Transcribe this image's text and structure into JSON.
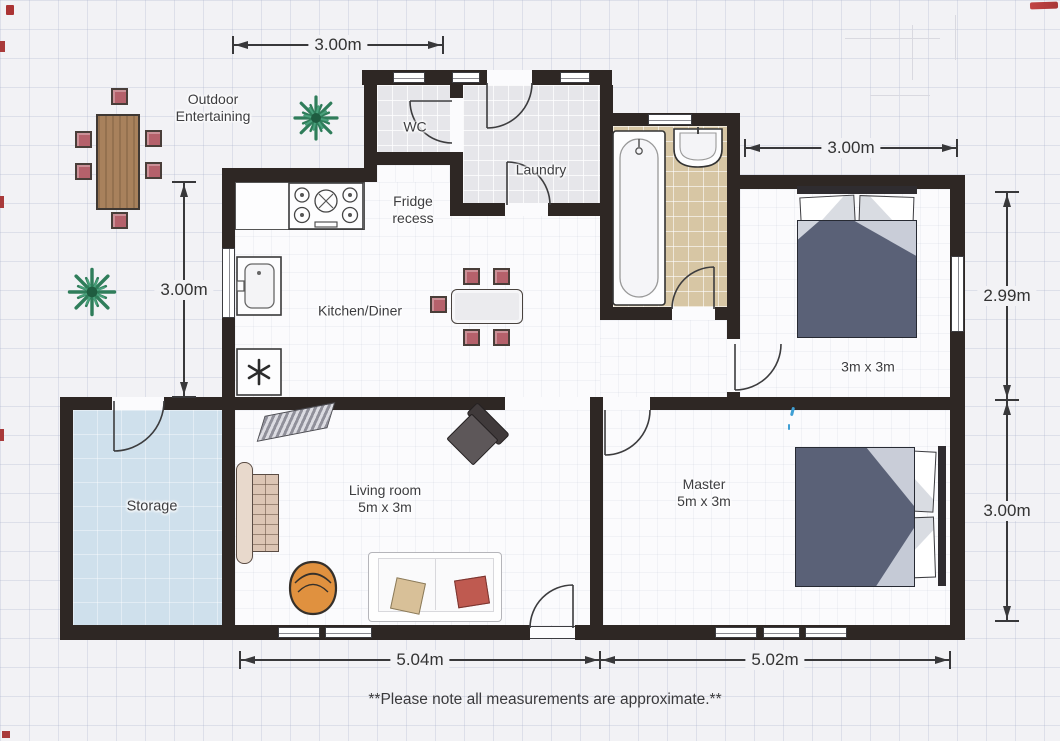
{
  "plan": {
    "note": "**Please note all measurements are approximate.**",
    "rooms": {
      "outdoor": {
        "line1": "Outdoor",
        "line2": "Entertaining"
      },
      "wc": {
        "name": "WC"
      },
      "laundry": {
        "name": "Laundry"
      },
      "fridge_recess": {
        "line1": "Fridge",
        "line2": "recess"
      },
      "kitchen": {
        "name": "Kitchen/Diner"
      },
      "storage": {
        "name": "Storage"
      },
      "living": {
        "name": "Living room",
        "size": "5m x 3m"
      },
      "master": {
        "name": "Master",
        "size": "5m x 3m"
      },
      "bedroom2": {
        "size": "3m x 3m"
      }
    },
    "dimensions": {
      "top_width": "3.00m",
      "left_height": "3.00m",
      "bedroom2_width": "3.00m",
      "bedroom2_height": "2.99m",
      "master_height": "3.00m",
      "living_width": "5.04m",
      "master_width": "5.02m"
    },
    "colors": {
      "wall": "#2e2724",
      "floor": "#fbfbfd",
      "storage_floor": "#cfe0ec",
      "bathroom_tile": "#d7c6a4",
      "utility_tile": "#e6e6ea",
      "bed_duvet": "#5a6177",
      "chair_pink": "#b5616b",
      "table_wood": "#a8815c",
      "plant_green": "#2f7d5a",
      "egg_chair_orange": "#e0913f",
      "sofa_cushion_red": "#bf5a50",
      "scan_mark_red": "#ab3434"
    }
  }
}
